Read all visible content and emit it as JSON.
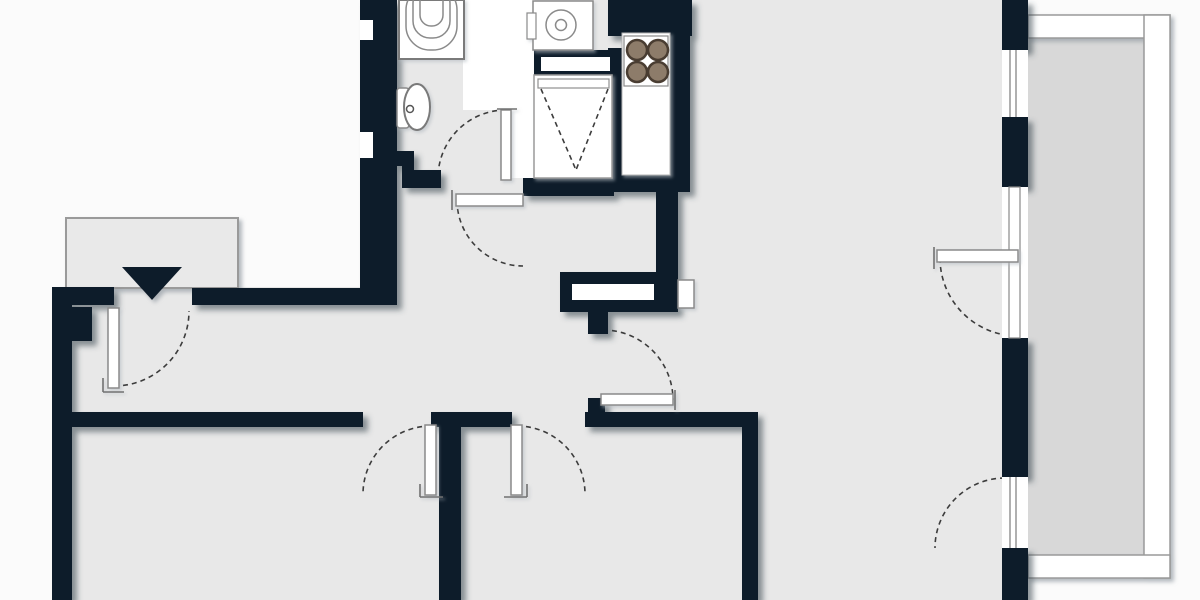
{
  "meta": {
    "title": "apartment-floor-plan",
    "canvas_width": 1200,
    "canvas_height": 600
  },
  "colors": {
    "wall": "#0e1c2b",
    "floor": "#e8e8e8",
    "outside": "#fbfbfb",
    "balcony_floor": "#d8d8d8",
    "porch": "#e9e9e9",
    "fixture_stroke": "#8a8a8a",
    "arc_stroke": "#3c3c3c",
    "burner_fill": "#8d7c6a",
    "burner_ring": "#4a3c30",
    "rail_stroke": "#9a9a9a"
  },
  "shapes": [
    {
      "n": "floor-main",
      "l": "floor",
      "k": "rect",
      "x": 362,
      "y": 0,
      "w": 330,
      "h": 600,
      "f": "#e8e8e8"
    },
    {
      "n": "floor-hall-left",
      "l": "floor",
      "k": "rect",
      "x": 52,
      "y": 287,
      "w": 310,
      "h": 313,
      "f": "#e8e8e8"
    },
    {
      "n": "floor-living-room",
      "l": "floor",
      "k": "rect",
      "x": 692,
      "y": 0,
      "w": 310,
      "h": 600,
      "f": "#e8e8e8"
    },
    {
      "n": "floor-balcony",
      "l": "floor",
      "k": "rect",
      "x": 1028,
      "y": 38,
      "w": 116,
      "h": 517,
      "f": "#d8d8d8"
    },
    {
      "n": "utility-white-area",
      "l": "under",
      "k": "rect",
      "x": 463,
      "y": 0,
      "w": 72,
      "h": 110,
      "f": "#ffffff"
    },
    {
      "n": "utility-white-door-area",
      "l": "under",
      "k": "rect",
      "x": 511,
      "y": 110,
      "w": 24,
      "h": 68,
      "f": "#ffffff"
    },
    {
      "n": "entrance-door-arc",
      "l": "under",
      "k": "path",
      "d": "M 114 386 A 75 75 0 0 0 189 311",
      "s": "#3c3c3c",
      "sw": 1.6,
      "da": "5 4",
      "f": "none"
    },
    {
      "n": "bathroom-door-arc",
      "l": "under",
      "k": "path",
      "d": "M 506 110 A 68 68 0 0 0 438 178",
      "s": "#3c3c3c",
      "sw": 1.6,
      "da": "5 4",
      "f": "none"
    },
    {
      "n": "hall-door-arc",
      "l": "under",
      "k": "path",
      "d": "M 457 200 A 66 66 0 0 0 523 266",
      "s": "#3c3c3c",
      "sw": 1.6,
      "da": "5 4",
      "f": "none"
    },
    {
      "n": "room1-door-arc",
      "l": "under",
      "k": "path",
      "d": "M 431 426 A 68 68 0 0 0 363 494",
      "s": "#3c3c3c",
      "sw": 1.6,
      "da": "5 4",
      "f": "none"
    },
    {
      "n": "room2-door-arc",
      "l": "under",
      "k": "path",
      "d": "M 517 426 A 68 68 0 0 1 585 494",
      "s": "#3c3c3c",
      "sw": 1.6,
      "da": "5 4",
      "f": "none"
    },
    {
      "n": "living-door-arc",
      "l": "under",
      "k": "path",
      "d": "M 603 330 A 70 70 0 0 1 673 400",
      "s": "#3c3c3c",
      "sw": 1.6,
      "da": "5 4",
      "f": "none"
    },
    {
      "n": "balcony-door-arc",
      "l": "under",
      "k": "path",
      "d": "M 940 258 A 78 78 0 0 0 1018 336",
      "s": "#3c3c3c",
      "sw": 1.6,
      "da": "5 4",
      "f": "none"
    },
    {
      "n": "french-window-arc",
      "l": "under",
      "k": "path",
      "d": "M 1005 478 A 70 70 0 0 0 935 548",
      "s": "#3c3c3c",
      "sw": 1.6,
      "da": "5 4",
      "f": "none"
    },
    {
      "n": "entrance-landing",
      "l": "soft",
      "k": "rect",
      "x": 66,
      "y": 218,
      "w": 172,
      "h": 70,
      "f": "#e9e9e9",
      "s": "#9a9a9a",
      "sw": 2
    },
    {
      "n": "entrance-arrow",
      "l": "soft",
      "k": "polygon",
      "pts": "122,267 182,267 152,300",
      "f": "#0e1c2b"
    },
    {
      "n": "balcony-rail-top",
      "l": "soft",
      "k": "rect",
      "x": 1028,
      "y": 15,
      "w": 142,
      "h": 23,
      "f": "#ffffff",
      "s": "#9a9a9a",
      "sw": 1.5
    },
    {
      "n": "balcony-rail-right",
      "l": "soft",
      "k": "rect",
      "x": 1144,
      "y": 15,
      "w": 26,
      "h": 563,
      "f": "#ffffff",
      "s": "#9a9a9a",
      "sw": 1.5
    },
    {
      "n": "balcony-rail-bottom",
      "l": "soft",
      "k": "rect",
      "x": 1028,
      "y": 555,
      "w": 142,
      "h": 23,
      "f": "#ffffff",
      "s": "#9a9a9a",
      "sw": 1.5
    },
    {
      "n": "wall-entry-left",
      "l": "wall",
      "k": "rect",
      "x": 52,
      "y": 287,
      "w": 62,
      "h": 18,
      "f": "#0e1c2b"
    },
    {
      "n": "wall-exterior-left",
      "l": "wall",
      "k": "rect",
      "x": 52,
      "y": 287,
      "w": 20,
      "h": 313,
      "f": "#0e1c2b"
    },
    {
      "n": "wall-step",
      "l": "wall",
      "k": "rect",
      "x": 72,
      "y": 307,
      "w": 20,
      "h": 34,
      "f": "#0e1c2b"
    },
    {
      "n": "wall-hall-top",
      "l": "wall",
      "k": "rect",
      "x": 192,
      "y": 288,
      "w": 176,
      "h": 17,
      "f": "#0e1c2b"
    },
    {
      "n": "wall-bathroom-left",
      "l": "wall",
      "k": "rect",
      "x": 360,
      "y": 0,
      "w": 37,
      "h": 305,
      "f": "#0e1c2b"
    },
    {
      "n": "wall-bath-z1",
      "l": "wall",
      "k": "rect",
      "x": 390,
      "y": 151,
      "w": 24,
      "h": 15,
      "f": "#0e1c2b"
    },
    {
      "n": "wall-bath-z2",
      "l": "wall",
      "k": "rect",
      "x": 402,
      "y": 151,
      "w": 12,
      "h": 37,
      "f": "#0e1c2b"
    },
    {
      "n": "wall-bath-z3",
      "l": "wall",
      "k": "rect",
      "x": 402,
      "y": 170,
      "w": 39,
      "h": 18,
      "f": "#0e1c2b"
    },
    {
      "n": "wall-utility-bottom",
      "l": "wall",
      "k": "rect",
      "x": 523,
      "y": 178,
      "w": 91,
      "h": 18,
      "f": "#0e1c2b"
    },
    {
      "n": "wall-shelf-band",
      "l": "wall",
      "k": "rect",
      "x": 534,
      "y": 50,
      "w": 80,
      "h": 25,
      "f": "#0e1c2b"
    },
    {
      "n": "wall-closet-right",
      "l": "wall",
      "k": "rect",
      "x": 608,
      "y": 48,
      "w": 18,
      "h": 144,
      "f": "#0e1c2b"
    },
    {
      "n": "wall-kitchen-top",
      "l": "wall",
      "k": "rect",
      "x": 608,
      "y": 0,
      "w": 84,
      "h": 36,
      "f": "#0e1c2b"
    },
    {
      "n": "wall-kitchen-cap",
      "l": "wall",
      "k": "rect",
      "x": 608,
      "y": 175,
      "w": 82,
      "h": 17,
      "f": "#0e1c2b"
    },
    {
      "n": "wall-kitchen-right",
      "l": "wall",
      "k": "rect",
      "x": 664,
      "y": 0,
      "w": 26,
      "h": 192,
      "f": "#0e1c2b"
    },
    {
      "n": "wall-hall-living",
      "l": "wall",
      "k": "rect",
      "x": 656,
      "y": 180,
      "w": 22,
      "h": 132,
      "f": "#0e1c2b"
    },
    {
      "n": "wall-niche-block",
      "l": "wall",
      "k": "rect",
      "x": 560,
      "y": 272,
      "w": 118,
      "h": 40,
      "f": "#0e1c2b"
    },
    {
      "n": "wall-stub-upper",
      "l": "wall",
      "k": "rect",
      "x": 588,
      "y": 312,
      "w": 20,
      "h": 22,
      "f": "#0e1c2b"
    },
    {
      "n": "wall-stub-lower",
      "l": "wall",
      "k": "rect",
      "x": 588,
      "y": 398,
      "w": 17,
      "h": 15,
      "f": "#0e1c2b"
    },
    {
      "n": "wall-hall-long",
      "l": "wall",
      "k": "rect",
      "x": 68,
      "y": 412,
      "w": 295,
      "h": 15,
      "f": "#0e1c2b"
    },
    {
      "n": "wall-pier-between-doors",
      "l": "wall",
      "k": "rect",
      "x": 431,
      "y": 412,
      "w": 81,
      "h": 15,
      "f": "#0e1c2b"
    },
    {
      "n": "wall-bottom-right",
      "l": "wall",
      "k": "rect",
      "x": 585,
      "y": 412,
      "w": 173,
      "h": 15,
      "f": "#0e1c2b"
    },
    {
      "n": "wall-room-divider",
      "l": "wall",
      "k": "rect",
      "x": 439,
      "y": 412,
      "w": 22,
      "h": 188,
      "f": "#0e1c2b"
    },
    {
      "n": "wall-living-left",
      "l": "wall",
      "k": "rect",
      "x": 742,
      "y": 412,
      "w": 16,
      "h": 188,
      "f": "#0e1c2b"
    },
    {
      "n": "wall-right-1",
      "l": "wall",
      "k": "rect",
      "x": 1002,
      "y": 0,
      "w": 26,
      "h": 50,
      "f": "#0e1c2b"
    },
    {
      "n": "wall-right-2",
      "l": "wall",
      "k": "rect",
      "x": 1002,
      "y": 117,
      "w": 26,
      "h": 70,
      "f": "#0e1c2b"
    },
    {
      "n": "wall-right-3",
      "l": "wall",
      "k": "rect",
      "x": 1002,
      "y": 338,
      "w": 26,
      "h": 139,
      "f": "#0e1c2b"
    },
    {
      "n": "wall-right-4",
      "l": "wall",
      "k": "rect",
      "x": 1002,
      "y": 548,
      "w": 26,
      "h": 52,
      "f": "#0e1c2b"
    },
    {
      "n": "wall-notch-1",
      "l": "inset",
      "k": "rect",
      "x": 360,
      "y": 20,
      "w": 13,
      "h": 20,
      "f": "#ffffff"
    },
    {
      "n": "wall-notch-2",
      "l": "inset",
      "k": "rect",
      "x": 360,
      "y": 132,
      "w": 13,
      "h": 26,
      "f": "#ffffff"
    },
    {
      "n": "shelf-slot",
      "l": "inset",
      "k": "rect",
      "x": 541,
      "y": 57,
      "w": 69,
      "h": 14,
      "f": "#ffffff"
    },
    {
      "n": "niche-slot",
      "l": "inset",
      "k": "rect",
      "x": 572,
      "y": 284,
      "w": 82,
      "h": 16,
      "f": "#ffffff"
    },
    {
      "n": "window-1",
      "l": "inset",
      "k": "rect",
      "x": 1002,
      "y": 50,
      "w": 26,
      "h": 67,
      "f": "#ffffff"
    },
    {
      "n": "window-1-glaze-a",
      "l": "inset",
      "k": "line",
      "x1": 1010,
      "y1": 50,
      "x2": 1010,
      "y2": 117,
      "s": "#858585",
      "sw": 1.3
    },
    {
      "n": "window-1-glaze-b",
      "l": "inset",
      "k": "line",
      "x1": 1016,
      "y1": 50,
      "x2": 1016,
      "y2": 117,
      "s": "#858585",
      "sw": 1.3
    },
    {
      "n": "balcony-door-opening",
      "l": "inset",
      "k": "rect",
      "x": 1002,
      "y": 187,
      "w": 26,
      "h": 151,
      "f": "#ffffff"
    },
    {
      "n": "balcony-door-frame",
      "l": "inset",
      "k": "rect",
      "x": 1009,
      "y": 187,
      "w": 11,
      "h": 151,
      "f": "#ffffff",
      "s": "#888888",
      "sw": 1.2
    },
    {
      "n": "window-2",
      "l": "inset",
      "k": "rect",
      "x": 1002,
      "y": 477,
      "w": 26,
      "h": 71,
      "f": "#ffffff"
    },
    {
      "n": "window-2-glaze-a",
      "l": "inset",
      "k": "line",
      "x1": 1010,
      "y1": 477,
      "x2": 1010,
      "y2": 548,
      "s": "#858585",
      "sw": 1.3
    },
    {
      "n": "window-2-glaze-b",
      "l": "inset",
      "k": "line",
      "x1": 1016,
      "y1": 477,
      "x2": 1016,
      "y2": 548,
      "s": "#858585",
      "sw": 1.3
    },
    {
      "n": "bathtub",
      "l": "fix",
      "k": "rect",
      "x": 399,
      "y": 0,
      "w": 65,
      "h": 59,
      "f": "#ffffff",
      "s": "#7a7a7a",
      "sw": 2
    },
    {
      "n": "bathtub-rim-1",
      "l": "fix",
      "k": "rect",
      "x": 406,
      "y": -14,
      "w": 51,
      "h": 64,
      "rx": 24,
      "f": "none",
      "s": "#8a8a8a",
      "sw": 1.5
    },
    {
      "n": "bathtub-rim-2",
      "l": "fix",
      "k": "rect",
      "x": 413,
      "y": -14,
      "w": 37,
      "h": 52,
      "rx": 17,
      "f": "none",
      "s": "#8a8a8a",
      "sw": 1.5
    },
    {
      "n": "bathtub-rim-3",
      "l": "fix",
      "k": "rect",
      "x": 420,
      "y": -14,
      "w": 23,
      "h": 40,
      "rx": 11,
      "f": "none",
      "s": "#8a8a8a",
      "sw": 1.5
    },
    {
      "n": "toilet-tank",
      "l": "fix",
      "k": "rect",
      "x": 397,
      "y": 88,
      "w": 12,
      "h": 40,
      "rx": 3,
      "f": "#ffffff",
      "s": "#8a8a8a",
      "sw": 1.5
    },
    {
      "n": "toilet-bowl",
      "l": "fix",
      "k": "ellipse",
      "cx": 417,
      "cy": 107,
      "rx": 13,
      "ry": 23,
      "f": "#ffffff",
      "s": "#7a7a7a",
      "sw": 2
    },
    {
      "n": "toilet-flush-dot",
      "l": "fix",
      "k": "circle",
      "cx": 410,
      "cy": 109,
      "r": 3.5,
      "f": "#ffffff",
      "s": "#555555",
      "sw": 1.5
    },
    {
      "n": "washing-machine",
      "l": "fix",
      "k": "rect",
      "x": 533,
      "y": 1,
      "w": 60,
      "h": 49,
      "f": "#ffffff",
      "s": "#8a8a8a",
      "sw": 1.5
    },
    {
      "n": "washing-machine-drawer",
      "l": "fix",
      "k": "rect",
      "x": 527,
      "y": 13,
      "w": 9,
      "h": 26,
      "f": "#ffffff",
      "s": "#8a8a8a",
      "sw": 1.2
    },
    {
      "n": "washing-machine-drum",
      "l": "fix",
      "k": "circle",
      "cx": 561,
      "cy": 25,
      "r": 15,
      "f": "#ffffff",
      "s": "#8a8a8a",
      "sw": 1.5
    },
    {
      "n": "washing-machine-hub",
      "l": "fix",
      "k": "circle",
      "cx": 561,
      "cy": 25,
      "r": 5.5,
      "f": "#ffffff",
      "s": "#8a8a8a",
      "sw": 1.5
    },
    {
      "n": "closet",
      "l": "fix",
      "k": "rect",
      "x": 534,
      "y": 75,
      "w": 78,
      "h": 103,
      "f": "#ffffff",
      "s": "#9a9a9a",
      "sw": 1.5
    },
    {
      "n": "closet-shelf",
      "l": "fix",
      "k": "rect",
      "x": 538,
      "y": 79,
      "w": 71,
      "h": 9,
      "f": "#ffffff",
      "s": "#909090",
      "sw": 1.2
    },
    {
      "n": "closet-v-left",
      "l": "fix",
      "k": "line",
      "x1": 541,
      "y1": 89,
      "x2": 576,
      "y2": 170,
      "s": "#3c3c3c",
      "sw": 1.6,
      "da": "5 4"
    },
    {
      "n": "closet-v-right",
      "l": "fix",
      "k": "line",
      "x1": 608,
      "y1": 89,
      "x2": 576,
      "y2": 170,
      "s": "#3c3c3c",
      "sw": 1.6,
      "da": "5 4"
    },
    {
      "n": "kitchen-counter",
      "l": "fix",
      "k": "rect",
      "x": 622,
      "y": 33,
      "w": 48,
      "h": 142,
      "f": "#ffffff",
      "s": "#b5b5b5",
      "sw": 1
    },
    {
      "n": "stove-box",
      "l": "fix",
      "k": "rect",
      "x": 624,
      "y": 36,
      "w": 44,
      "h": 50,
      "f": "#ffffff",
      "s": "#8a8a8a",
      "sw": 1.2
    },
    {
      "n": "stove-burner-1",
      "l": "fix",
      "k": "circle",
      "cx": 637,
      "cy": 50,
      "r": 10,
      "f": "#8d7c6a",
      "s": "#4a3c30",
      "sw": 2.5
    },
    {
      "n": "stove-burner-2",
      "l": "fix",
      "k": "circle",
      "cx": 658,
      "cy": 50,
      "r": 10,
      "f": "#8d7c6a",
      "s": "#4a3c30",
      "sw": 2.5
    },
    {
      "n": "stove-burner-3",
      "l": "fix",
      "k": "circle",
      "cx": 637,
      "cy": 72,
      "r": 10,
      "f": "#8d7c6a",
      "s": "#4a3c30",
      "sw": 2.5
    },
    {
      "n": "stove-burner-4",
      "l": "fix",
      "k": "circle",
      "cx": 658,
      "cy": 72,
      "r": 10,
      "f": "#8d7c6a",
      "s": "#4a3c30",
      "sw": 2.5
    },
    {
      "n": "radiator",
      "l": "fix",
      "k": "rect",
      "x": 678,
      "y": 280,
      "w": 16,
      "h": 28,
      "f": "#ffffff",
      "s": "#8a8a8a",
      "sw": 1.5
    },
    {
      "n": "entrance-door-leaf",
      "l": "fix",
      "k": "rect",
      "x": 108,
      "y": 308,
      "w": 11,
      "h": 80,
      "f": "#ffffff",
      "s": "#8a8a8a",
      "sw": 1.5
    },
    {
      "n": "bathroom-door-leaf",
      "l": "fix",
      "k": "rect",
      "x": 501,
      "y": 110,
      "w": 10,
      "h": 70,
      "f": "#ffffff",
      "s": "#8a8a8a",
      "sw": 1.5
    },
    {
      "n": "hall-door-leaf",
      "l": "fix",
      "k": "rect",
      "x": 456,
      "y": 194,
      "w": 67,
      "h": 12,
      "f": "#ffffff",
      "s": "#8a8a8a",
      "sw": 1.5
    },
    {
      "n": "room1-door-leaf",
      "l": "fix",
      "k": "rect",
      "x": 425,
      "y": 425,
      "w": 11,
      "h": 70,
      "f": "#ffffff",
      "s": "#8a8a8a",
      "sw": 1.5
    },
    {
      "n": "room2-door-leaf",
      "l": "fix",
      "k": "rect",
      "x": 511,
      "y": 425,
      "w": 11,
      "h": 70,
      "f": "#ffffff",
      "s": "#8a8a8a",
      "sw": 1.5
    },
    {
      "n": "living-door-leaf",
      "l": "fix",
      "k": "rect",
      "x": 601,
      "y": 394,
      "w": 72,
      "h": 11,
      "f": "#ffffff",
      "s": "#8a8a8a",
      "sw": 1.5
    },
    {
      "n": "balcony-door-leaf",
      "l": "fix",
      "k": "rect",
      "x": 937,
      "y": 250,
      "w": 81,
      "h": 12,
      "f": "#ffffff",
      "s": "#8a8a8a",
      "sw": 1.5
    },
    {
      "n": "entrance-door-tick-a",
      "l": "fix",
      "k": "line",
      "x1": 103,
      "y1": 378,
      "x2": 103,
      "y2": 392,
      "s": "#707070",
      "sw": 1.6
    },
    {
      "n": "entrance-door-tick-b",
      "l": "fix",
      "k": "line",
      "x1": 103,
      "y1": 392,
      "x2": 124,
      "y2": 392,
      "s": "#707070",
      "sw": 1.6
    },
    {
      "n": "bathroom-door-tick",
      "l": "fix",
      "k": "line",
      "x1": 497,
      "y1": 109,
      "x2": 517,
      "y2": 109,
      "s": "#707070",
      "sw": 1.6
    },
    {
      "n": "hall-door-tick",
      "l": "fix",
      "k": "line",
      "x1": 452,
      "y1": 190,
      "x2": 452,
      "y2": 210,
      "s": "#707070",
      "sw": 1.6
    },
    {
      "n": "room1-door-tick-a",
      "l": "fix",
      "k": "line",
      "x1": 420,
      "y1": 497,
      "x2": 443,
      "y2": 497,
      "s": "#707070",
      "sw": 1.6
    },
    {
      "n": "room1-door-tick-b",
      "l": "fix",
      "k": "line",
      "x1": 420,
      "y1": 484,
      "x2": 420,
      "y2": 497,
      "s": "#707070",
      "sw": 1.6
    },
    {
      "n": "room2-door-tick-a",
      "l": "fix",
      "k": "line",
      "x1": 504,
      "y1": 497,
      "x2": 527,
      "y2": 497,
      "s": "#707070",
      "sw": 1.6
    },
    {
      "n": "room2-door-tick-b",
      "l": "fix",
      "k": "line",
      "x1": 527,
      "y1": 484,
      "x2": 527,
      "y2": 497,
      "s": "#707070",
      "sw": 1.6
    },
    {
      "n": "living-door-tick",
      "l": "fix",
      "k": "line",
      "x1": 675,
      "y1": 390,
      "x2": 675,
      "y2": 410,
      "s": "#707070",
      "sw": 1.6
    },
    {
      "n": "balcony-door-tick",
      "l": "fix",
      "k": "line",
      "x1": 934,
      "y1": 247,
      "x2": 934,
      "y2": 269,
      "s": "#707070",
      "sw": 1.6
    }
  ]
}
